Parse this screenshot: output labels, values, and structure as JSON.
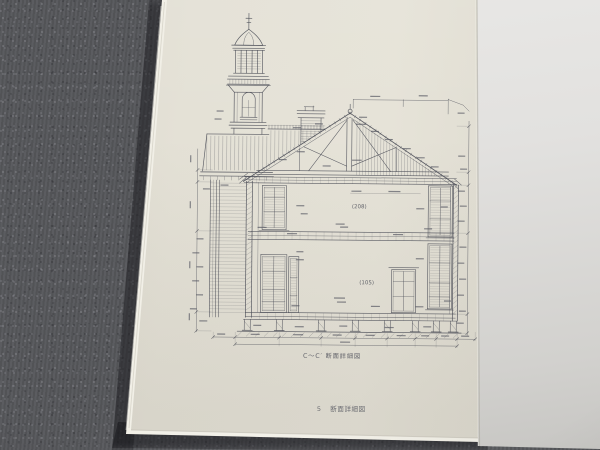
{
  "page": {
    "caption": "C〜C′ 断面詳細図",
    "footer": {
      "page_number": "5",
      "title": "断面詳細図"
    },
    "room_labels": {
      "second_floor": "(208)",
      "first_floor": "(105)"
    }
  },
  "colors": {
    "carpet": "#56575b",
    "drawing_page": "#e4e1d6",
    "facing_page": "#e2e1df",
    "ink": "#4a4c56"
  }
}
